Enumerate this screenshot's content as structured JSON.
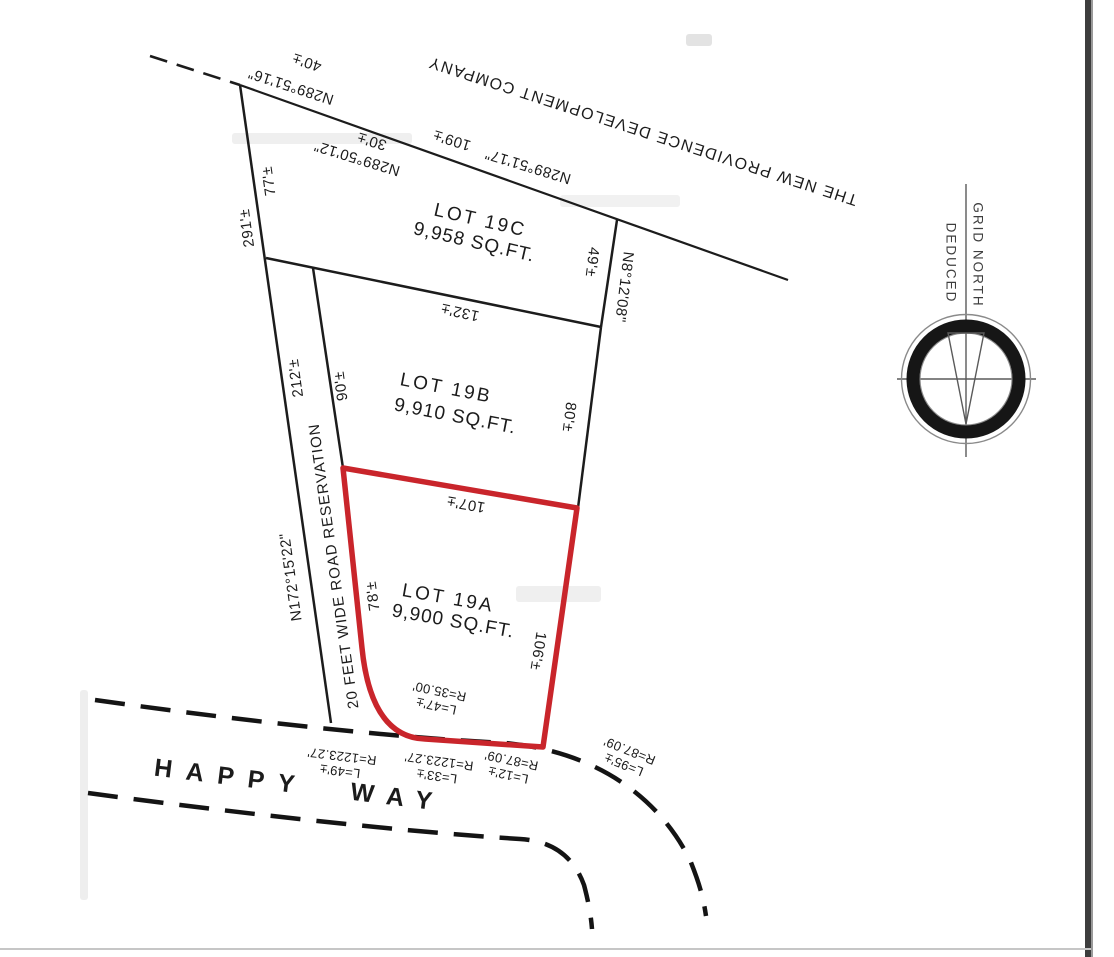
{
  "plat": {
    "owner": "THE NEW PROVIDENCE DEVELOPMENT COMPANY",
    "road_name": "HAPPY WAY",
    "reservation": {
      "label": "20 FEET WIDE ROAD RESERVATION",
      "bearing": "N172°15'22\""
    },
    "compass": {
      "line1": "GRID NORTH",
      "line2": "DEDUCED"
    },
    "lots": {
      "lot19a": {
        "name": "LOT 19A",
        "area": "9,900 SQ.FT."
      },
      "lot19b": {
        "name": "LOT 19B",
        "area": "9,910 SQ.FT."
      },
      "lot19c": {
        "name": "LOT 19C",
        "area": "9,958 SQ.FT."
      }
    },
    "rear_boundary": {
      "seg1": {
        "bearing": "N289°51'16\"",
        "distance": "40'±"
      },
      "seg2": {
        "bearing": "N289°50'12\"",
        "distance": "30'±"
      },
      "seg3": {
        "bearing": "N289°51'17\"",
        "distance": "109'±"
      }
    },
    "east_boundary": {
      "bearing": "N8°12'08\"",
      "distance": "49'±"
    },
    "dimensions": {
      "d291": "291'±",
      "d77": "77'±",
      "d212": "212'±",
      "d90": "90'±",
      "d132": "132'±",
      "d80": "80'±",
      "d107": "107'±",
      "d78": "78'±",
      "d106": "106'±"
    },
    "curves": {
      "c35": {
        "radius": "R=35.00'",
        "length": "L=47'±"
      },
      "c1223a": {
        "radius": "R=1223.27'",
        "length": "L=49'±"
      },
      "c1223b": {
        "radius": "R=1223.27'",
        "length": "L=33'±"
      },
      "c87a": {
        "radius": "R=87.09'",
        "length": "L=12'±"
      },
      "c87b": {
        "radius": "R=87.09'",
        "length": "L=95'±"
      }
    },
    "colors": {
      "highlight_red": "#c9252b",
      "line_black": "#1c1c1c"
    }
  }
}
